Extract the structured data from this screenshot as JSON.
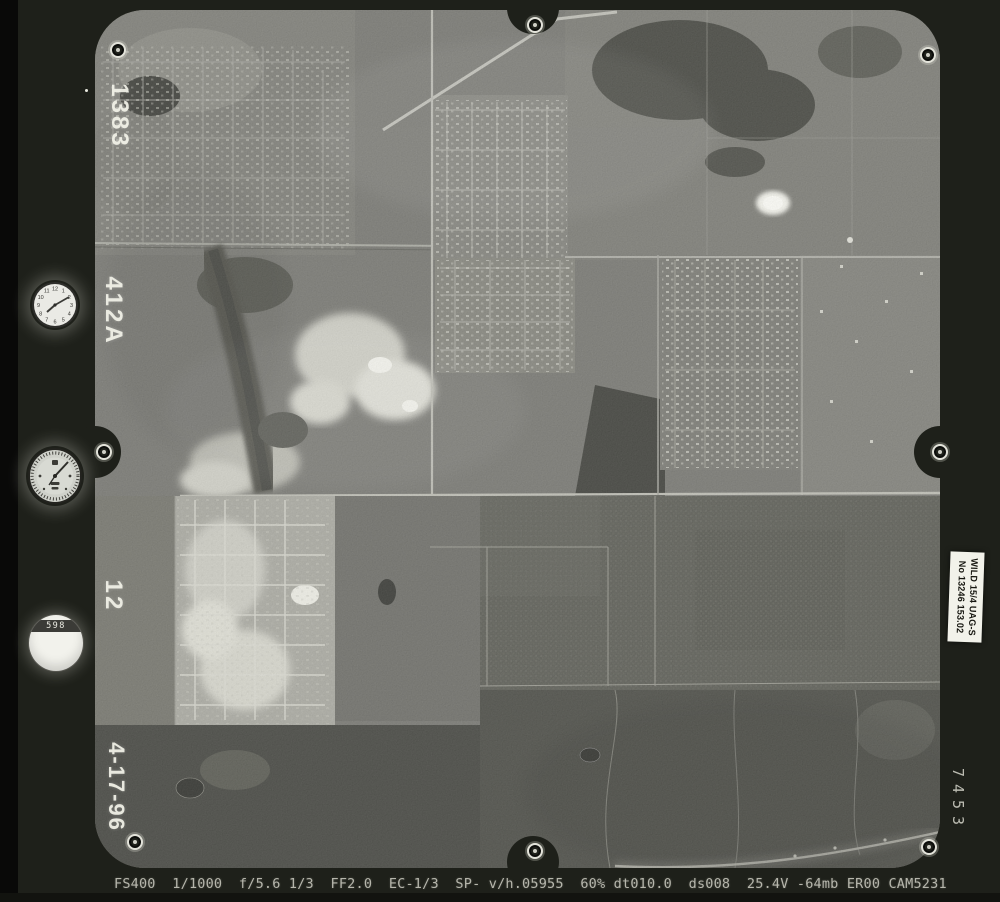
{
  "frame": {
    "type": "aerial-survey-film-frame",
    "margin": {
      "roll": "1383",
      "area_code": "412A",
      "strip_number": "12",
      "date": "4-17-96",
      "frame_number": "7453"
    },
    "camera_label": {
      "line1": "WILD 15/4 UAG-S",
      "line2": "No 13246 153.02"
    },
    "instruments": {
      "counter_value": "598",
      "clock_dial": [
        "12",
        "1",
        "2",
        "3",
        "4",
        "5",
        "6",
        "7",
        "8",
        "9",
        "10",
        "11"
      ]
    },
    "data_strip": {
      "text": "FS400  1/1000  f/5.6 1/3  FF2.0  EC-1/3  SP- v/h.05955  60% dt010.0  ds008  25.4V -64mb ER00 CAM5231"
    },
    "colors": {
      "film_border": "#1e201a",
      "photo_base": "#63635e",
      "forest_dark": "#34352f",
      "label_bg": "#f2f2ea",
      "annotation_text": "#f2f2e8",
      "data_text": "#b6b6ac"
    }
  }
}
